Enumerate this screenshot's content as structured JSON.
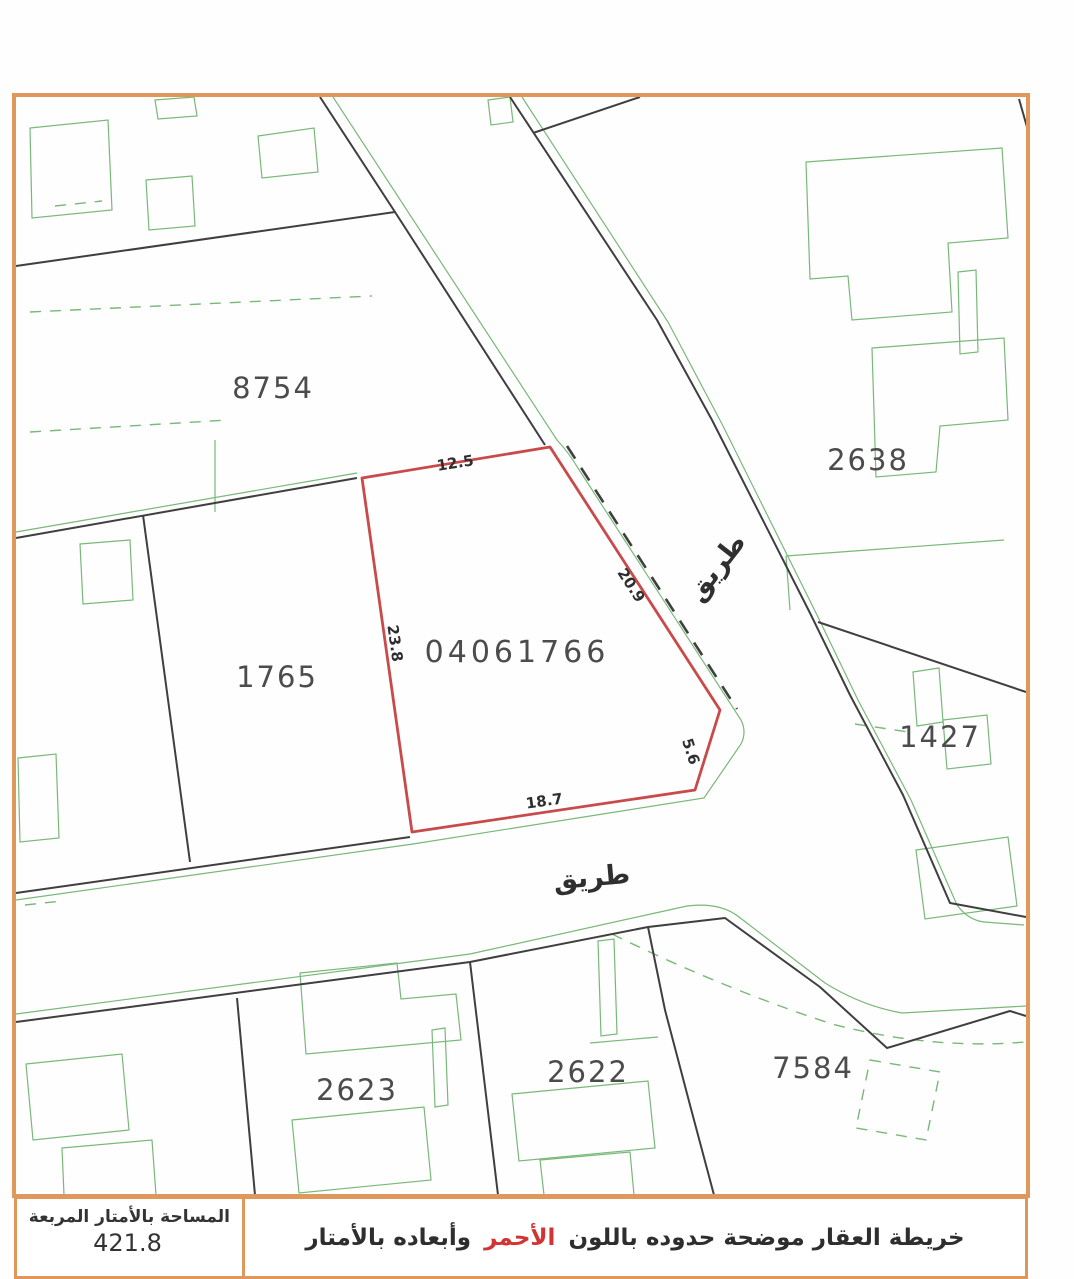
{
  "colors": {
    "frame_orange": "#E0975C",
    "subject_red": "#C84A4A",
    "survey_green": "#79B879",
    "line_ink": "#3F3F3F",
    "highlight_red": "#D23434"
  },
  "map": {
    "subject_parcel": {
      "number": "04061766",
      "side_lengths": {
        "north": "12.5",
        "northeast": "20.9",
        "west": "23.8",
        "southeast": "5.6",
        "south": "18.7"
      }
    },
    "adjacent_parcels": {
      "northwest": "8754",
      "northeast": "2638",
      "west": "1765",
      "east": "1427",
      "southwest": "2623",
      "south": "2622",
      "southeast": "7584"
    },
    "road_labels": {
      "vertical": "طريق",
      "horizontal": "طريق"
    }
  },
  "footer": {
    "area_label": "المساحة بالأمتار المربعة",
    "area_value": "421.8",
    "caption": {
      "before": "خريطة العقار موضحة حدوده باللون",
      "highlight": "الأحمر",
      "after": "وأبعاده بالأمتار"
    }
  }
}
